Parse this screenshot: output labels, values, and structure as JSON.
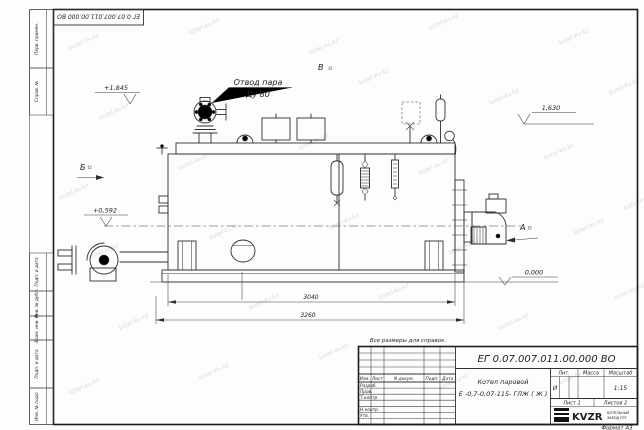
{
  "watermark": {
    "text": "kotel-kv.kz"
  },
  "corner_stamp": {
    "designation": "ЕГ 0.07.007.011.00.000  ВО"
  },
  "margin_labels": {
    "perv_primen": "Перв. примен.",
    "sprav_no": "Справ. №",
    "podp_data_1": "Подп. и дата",
    "inv_no_dubl": "Инв. № дубл.",
    "vzam_inv_no": "Взам. инв. №",
    "podp_data_2": "Подп. и дата",
    "inv_no_podl": "Инв. № подл."
  },
  "views": {
    "a": "А",
    "b": "Б",
    "v": "В"
  },
  "callout": {
    "line1": "Отвод пара",
    "line2": "Ду 80"
  },
  "elevations": {
    "top": "+1,845",
    "middle": "+0,592",
    "right": "1,630",
    "zero": "0,000"
  },
  "dimensions": {
    "drum_length": "3040",
    "overall_length": "3260"
  },
  "note": "Все размеры для справок.",
  "title_block": {
    "designation": "ЕГ 0.07.007.011.00.000  ВО",
    "product_name_line1": "Котел паровой",
    "product_name_line2": "Е -0,7-0,07-115- ГЛЖ ( Ж )",
    "col_izm": "Изм.",
    "col_list": "Лист",
    "col_doc": "N докум.",
    "col_podp": "Подп.",
    "col_data": "Дата",
    "row_razrab": "Разраб.",
    "row_prov": "Пров.",
    "row_tkontr": "Т.контр.",
    "row_nkontr": "Н.контр.",
    "row_utv": "Утв.",
    "lit_header": "Лит.",
    "massa_header": "Масса",
    "masshtab_header": "Масштаб",
    "lit_value": "И",
    "masshtab_value": "1:15",
    "sheet": "Лист 1",
    "sheets": "Листов 2",
    "logo_text": "KVZR",
    "logo_sub_line1": "КОТЕЛЬНЫЙ",
    "logo_sub_line2": "ЗАВОД РЭТ",
    "format_label": "Формат А3"
  }
}
